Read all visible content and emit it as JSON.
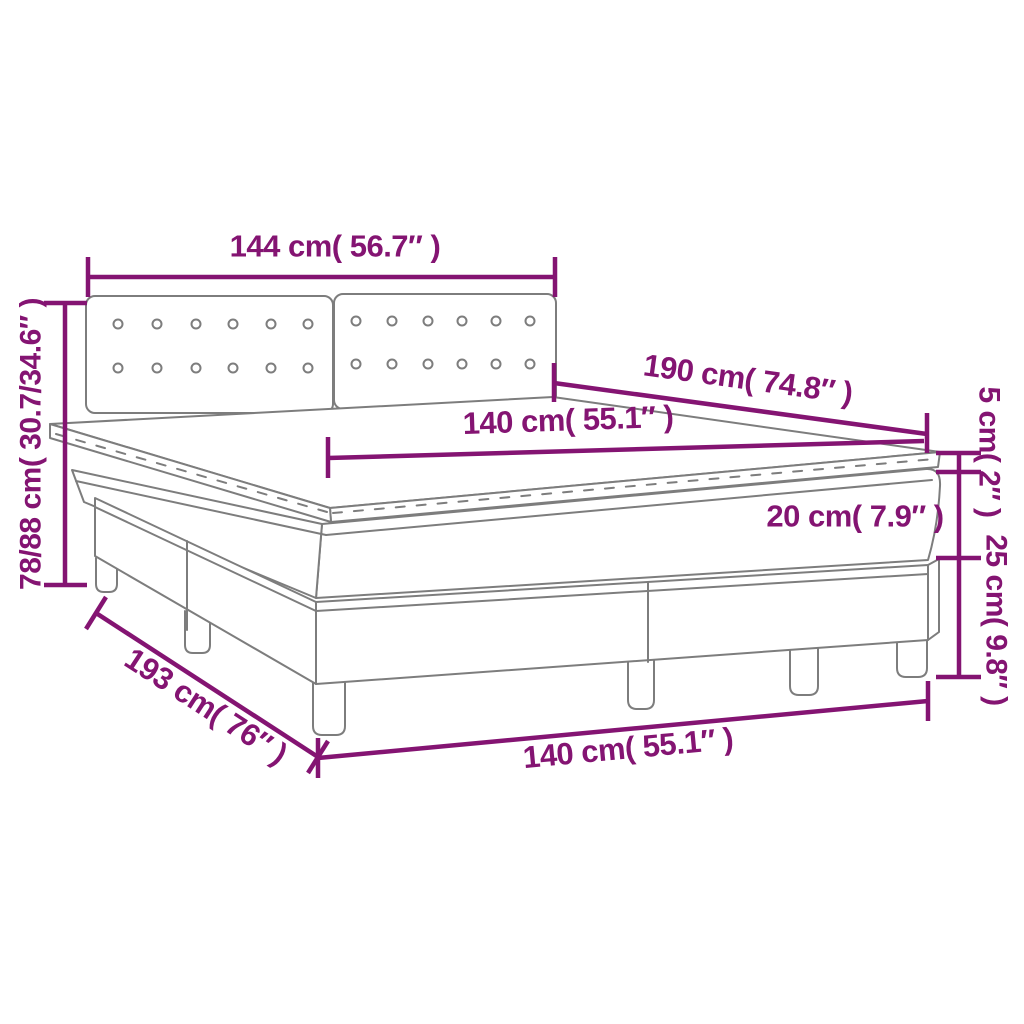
{
  "diagram": {
    "kind": "product-dimension-diagram",
    "product": "box-spring-bed-with-topper-and-tufted-headboard",
    "colors": {
      "dimension_accent": "#841472",
      "drawing_outline": "#7d7d7d",
      "background": "#ffffff"
    },
    "dimensions": {
      "headboard_width": "144 cm( 56.7″ )",
      "overall_height": "78/88 cm( 30.7/34.6″ )",
      "mattress_length": "190 cm( 74.8″ )",
      "mattress_top_width": "140 cm( 55.1″ )",
      "topper_thickness": "5 cm( 2″ )",
      "mattress_thickness": "20 cm( 7.9″ )",
      "base_height": "25 cm( 9.8″ )",
      "overall_length": "193 cm( 76″ )",
      "overall_width": "140 cm( 55.1″ )"
    },
    "bed": {
      "headboard_panels": 2,
      "button_rows_per_panel": 2,
      "buttons_per_row": 6,
      "visible_legs": 6,
      "base_sections": 2
    }
  }
}
